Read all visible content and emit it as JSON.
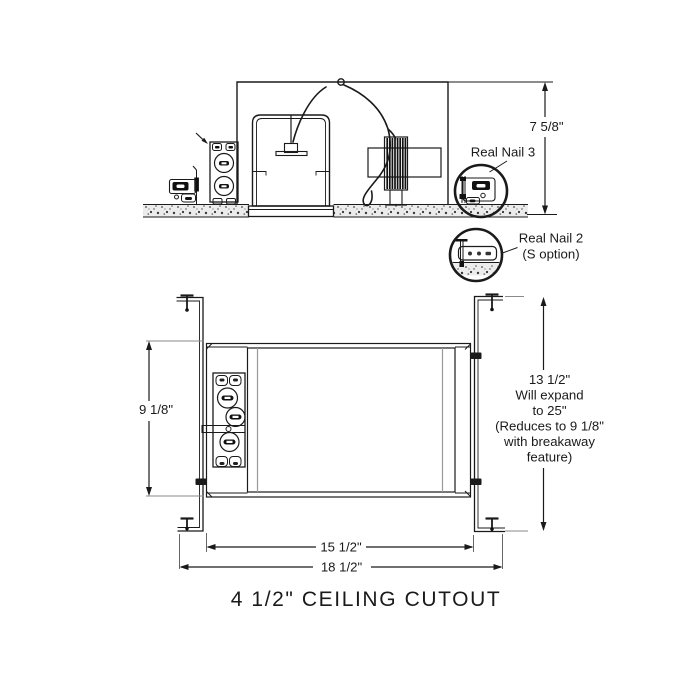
{
  "diagram": {
    "top_view": {
      "height_dim": "7 5/8\"",
      "detail_1_label": "Real Nail 3",
      "detail_2_label_line1": "Real Nail 2",
      "detail_2_label_line2": "(S option)"
    },
    "bottom_view": {
      "pan_height_dim": "9 1/8\"",
      "bar_note": [
        "13 1/2\"",
        "Will expand",
        "to 25\"",
        "(Reduces to 9 1/8\"",
        "with breakaway",
        "feature)"
      ],
      "inner_width_dim": "15 1/2\"",
      "outer_width_dim": "18 1/2\""
    },
    "caption": "4 1/2\" CEILING CUTOUT",
    "colors": {
      "line": "#1a1a1a",
      "tick": "#8a8a8a",
      "band_fill": "#ececec"
    }
  }
}
